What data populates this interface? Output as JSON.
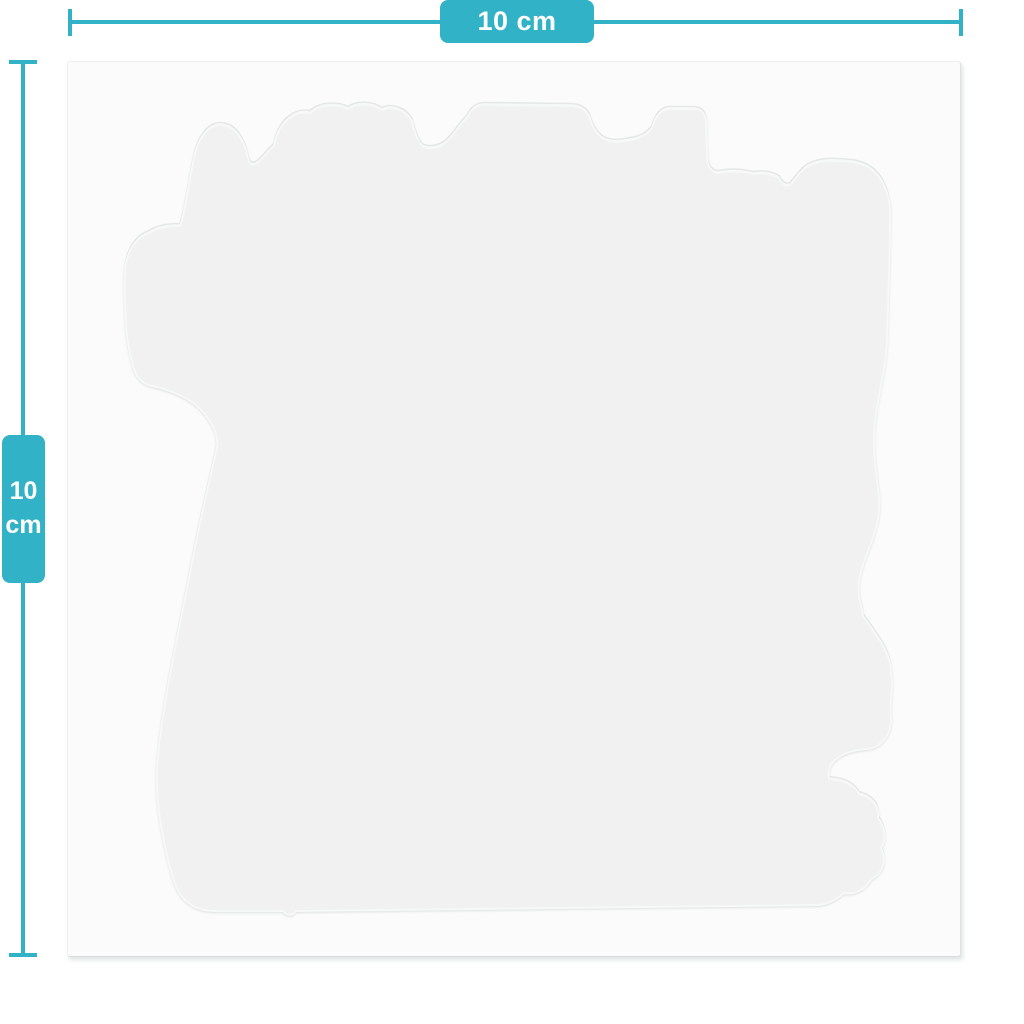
{
  "diagram": {
    "horizontal_dimension": {
      "label": "10 cm"
    },
    "vertical_dimension": {
      "value": "10",
      "unit": "cm"
    },
    "colors": {
      "accent": "#32b2c6",
      "badge_text": "#ffffff",
      "page_background": "#ffffff",
      "sheet_background": "#fbfbfc",
      "sticker_fill": "#f0f1f0",
      "sticker_edge": "#e3e6e6"
    }
  }
}
